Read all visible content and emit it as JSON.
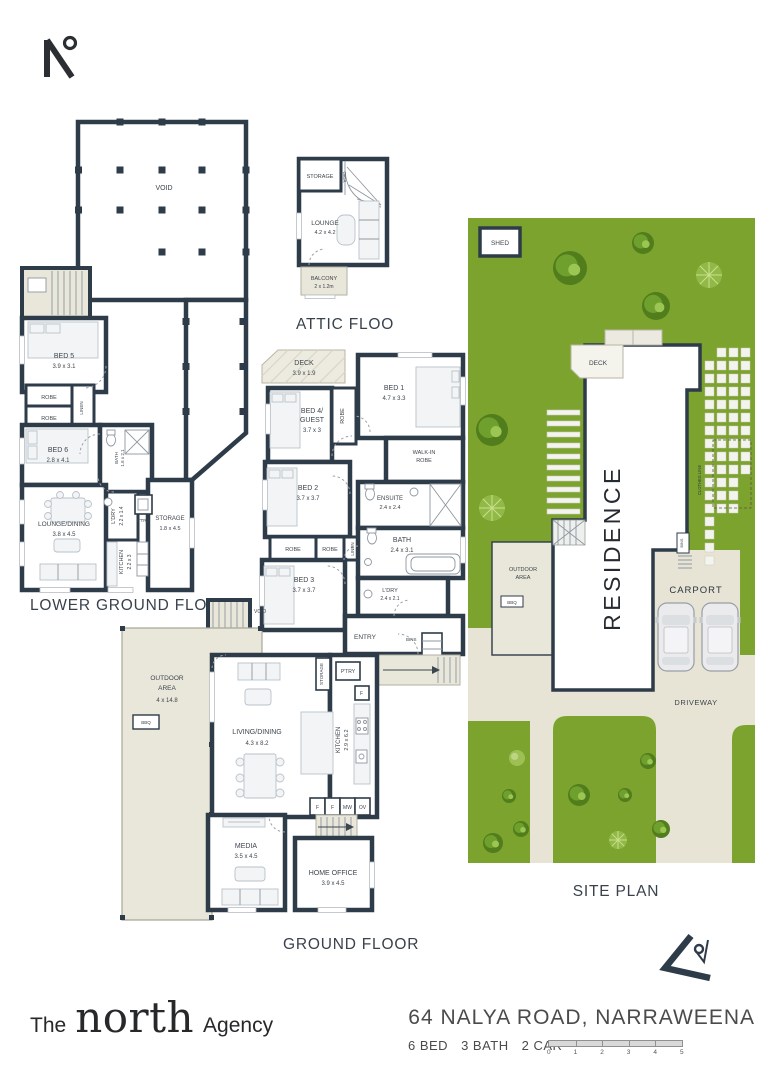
{
  "brand": {
    "the": "The",
    "north": "north",
    "agency": "Agency"
  },
  "footer": {
    "address": "64 NALYA ROAD, NARRAWEENA",
    "bed": "6 BED",
    "bath": "3 BATH",
    "car": "2 CAR",
    "scale": [
      "0",
      "1",
      "2",
      "3",
      "4",
      "5"
    ]
  },
  "lg": {
    "title": "LOWER GROUND FLOOR",
    "void": "VOID",
    "bed5": "BED 5",
    "bed5_d": "3.9 x 3.1",
    "robe_a": "ROBE",
    "robe_b": "ROBE",
    "linen": "LINEN",
    "bed6": "BED 6",
    "bed6_d": "2.8 x 4.1",
    "bath_v": "BATH",
    "bath_vd": "1.6 x 2.1",
    "ldry": "L'DRY",
    "ldry_d": "2.2 x 1.4",
    "ptry": "P'TRY",
    "kitchen": "KITCHEN",
    "kitchen_d": "2.2 x 3",
    "storage": "STORAGE",
    "storage_d": "1.8 x 4.5",
    "lounge": "LOUNGE/DINING",
    "lounge_d": "3.8 x 4.5"
  },
  "attic": {
    "title": "ATTIC FLOOR",
    "storage": "STORAGE",
    "void": "VOID",
    "lounge": "LOUNGE",
    "lounge_d": "4.2 x 4.2",
    "balcony": "BALCONY",
    "balcony_d": "2 x 1.2m"
  },
  "gf": {
    "title": "GROUND FLOOR",
    "deck": "DECK",
    "deck_d": "3.9 x 1.9",
    "bed1": "BED 1",
    "bed1_d": "4.7 x 3.3",
    "bed4_a": "BED 4/",
    "bed4_b": "GUEST",
    "bed4_d": "3.7 x 3",
    "robe_v": "ROBE",
    "wir_a": "WALK-IN",
    "wir_b": "ROBE",
    "ensuite": "ENSUITE",
    "ensuite_d": "2.4 x 2.4",
    "bed2": "BED 2",
    "bed2_d": "3.7 x 3.7",
    "robe_a": "ROBE",
    "robe_b": "ROBE",
    "linen": "LINEN",
    "bed3": "BED 3",
    "bed3_d": "3.7 x 3.7",
    "bath": "BATH",
    "bath_d": "2.4 x 3.1",
    "ldry": "L'DRY",
    "ldry_d": "2.4 x 2.1",
    "entry": "ENTRY",
    "bins": "BINS",
    "void": "VOID",
    "outdoor_a": "OUTDOOR",
    "outdoor_b": "AREA",
    "outdoor_d": "4 x 14.8",
    "bbq": "BBQ",
    "living": "LIVING/DINING",
    "living_d": "4.3 x 8.2",
    "kitchen": "KITCHEN",
    "kitchen_d": "2.9 x 6.2",
    "storage_v": "STORAGE",
    "ptry": "P'TRY",
    "f1": "F",
    "f2": "F",
    "f3": "F",
    "mw": "MW",
    "ov": "OV",
    "media": "MEDIA",
    "media_d": "3.5 x 4.5",
    "office": "HOME OFFICE",
    "office_d": "3.9 x 4.5"
  },
  "site": {
    "title": "SITE PLAN",
    "shed": "SHED",
    "deck": "DECK",
    "residence": "RESIDENCE",
    "outdoor_a": "OUTDOOR",
    "outdoor_b": "AREA",
    "bbq": "BBQ",
    "bins": "BINS",
    "clothes": "CLOTHES LINE",
    "carport": "CARPORT",
    "driveway": "DRIVEWAY"
  },
  "colors": {
    "wall": "#2e3b49",
    "grass": "#7ca32d",
    "paving": "#e9e6da",
    "text": "#3d454d"
  }
}
